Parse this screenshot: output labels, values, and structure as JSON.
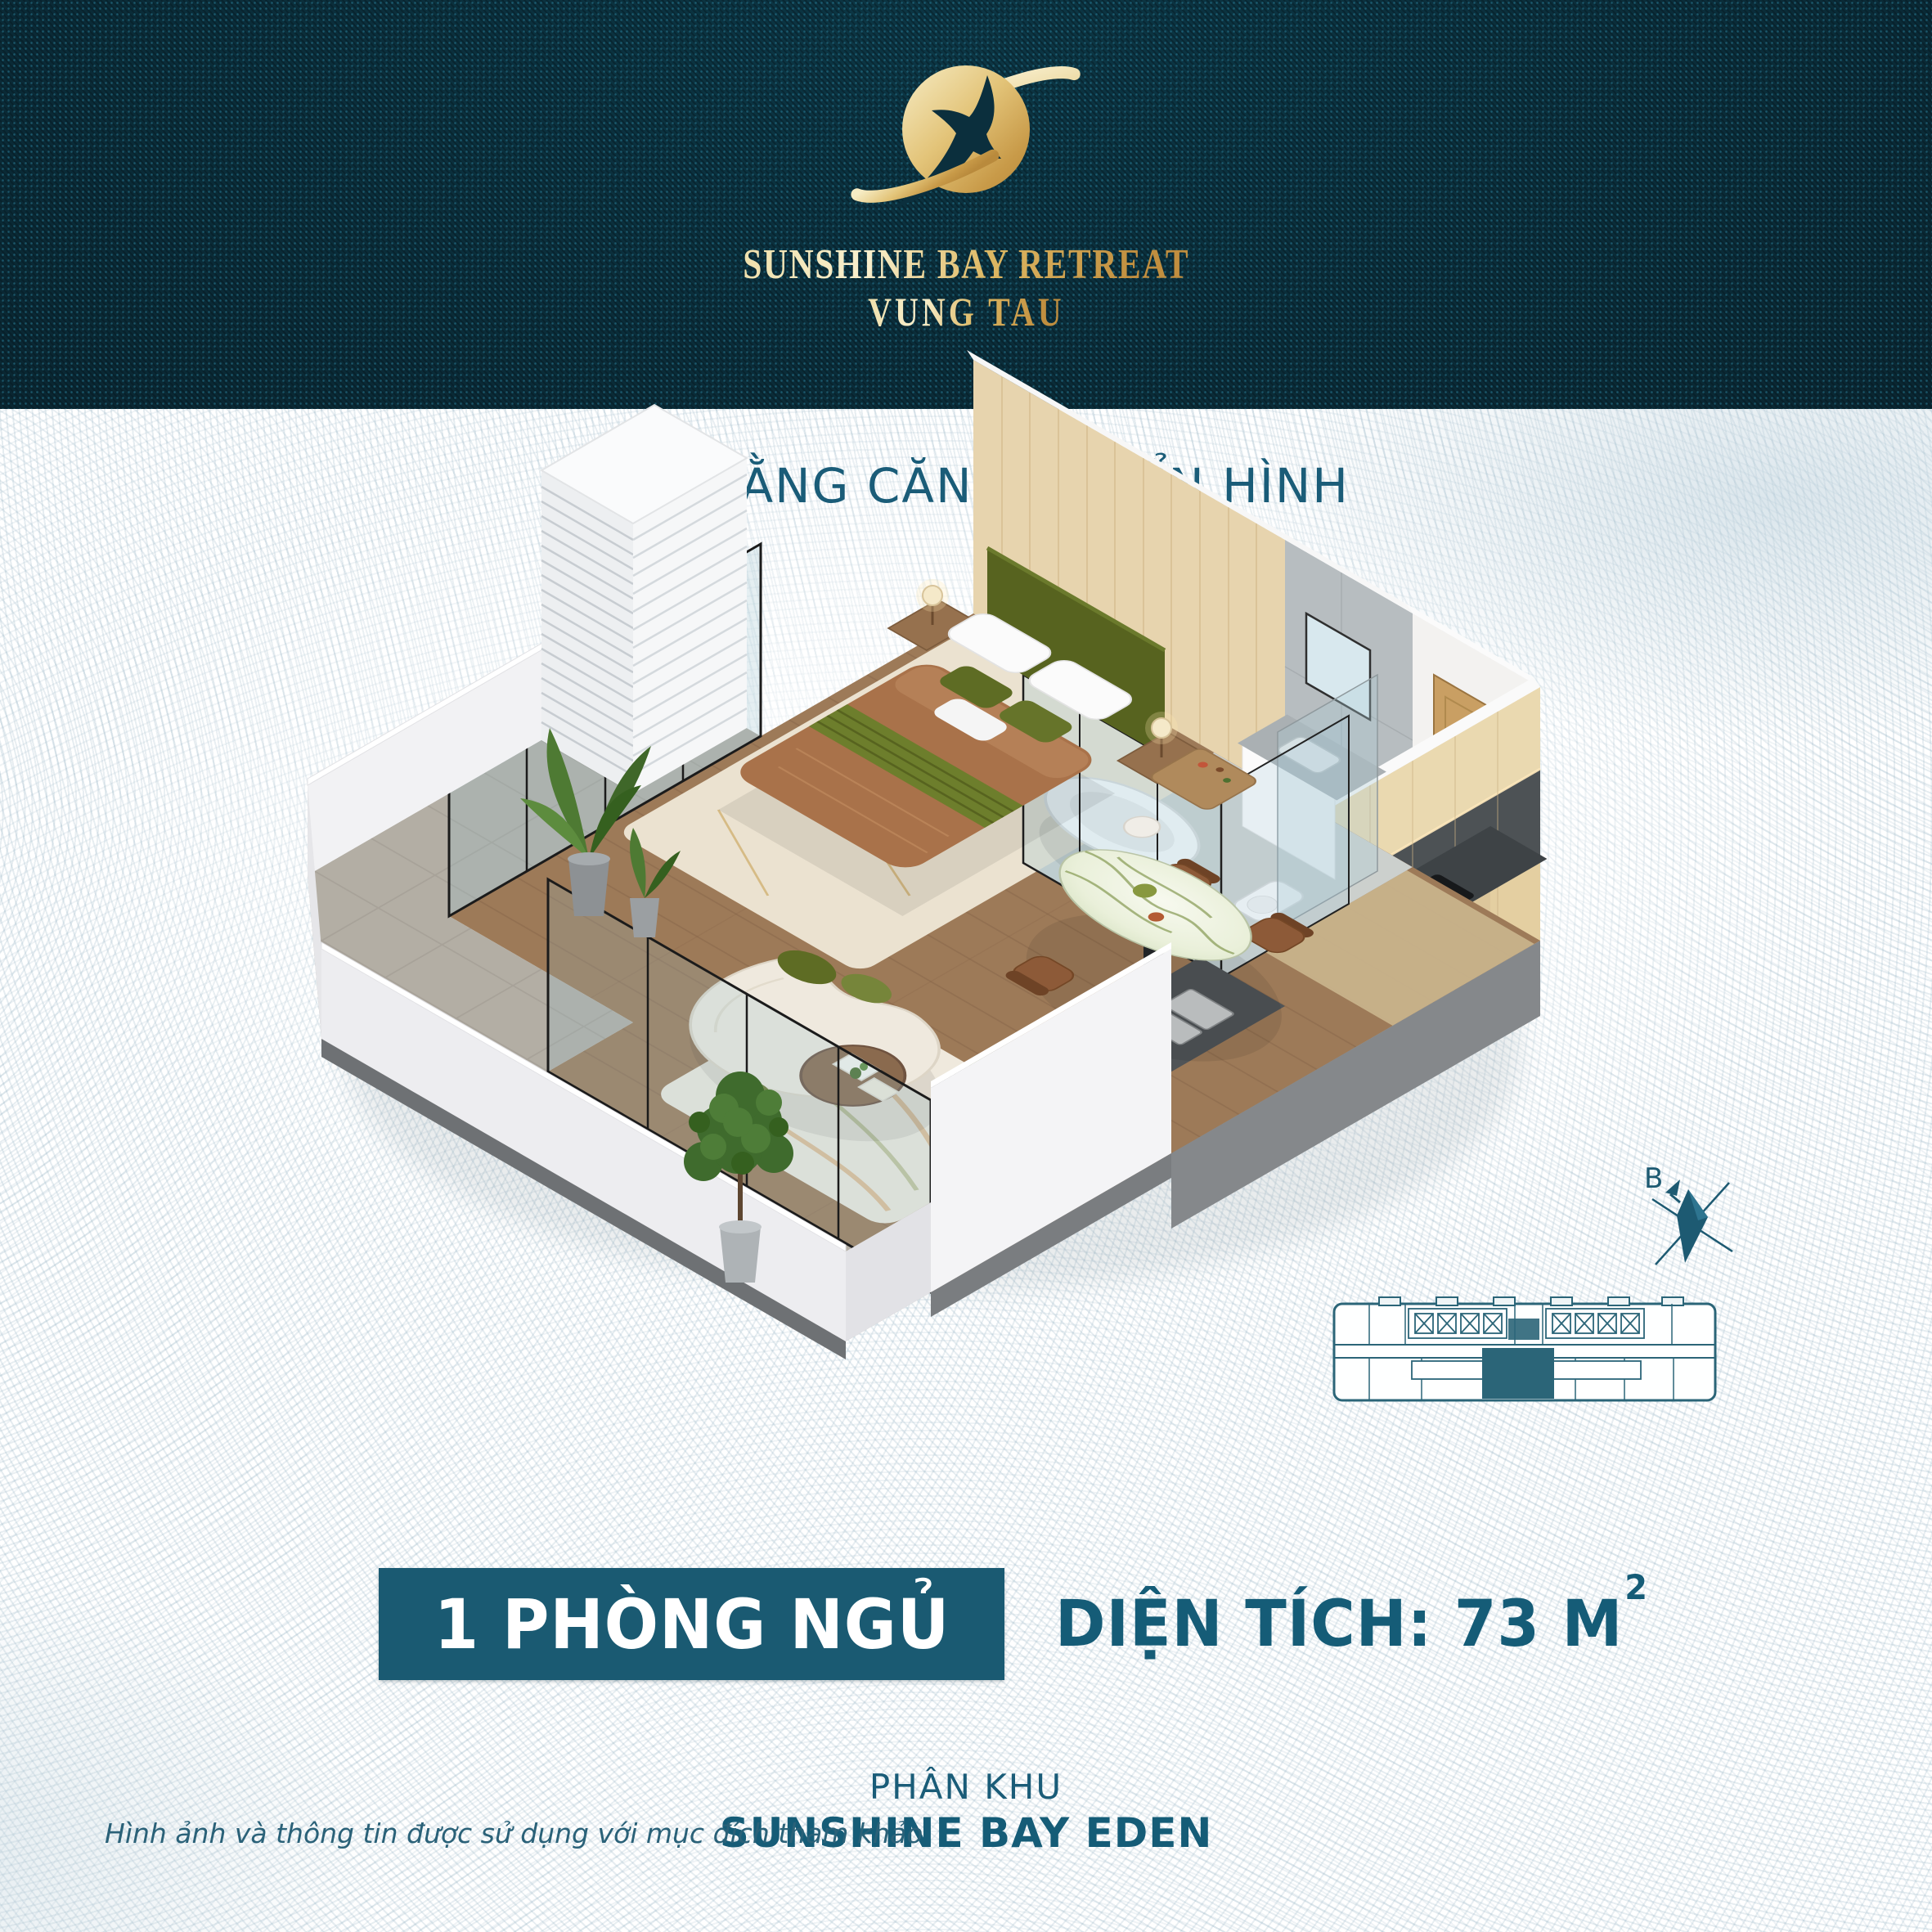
{
  "header": {
    "brand": "SUNSHINE BAY RETREAT",
    "location": "VUNG TAU",
    "logo_icon": "planet-star-icon",
    "background_color": "#0B2F3D",
    "gold_color": "#D9B45C"
  },
  "main": {
    "title": "MẶT BẰNG CĂN HỘ ĐIỂN HÌNH",
    "render_icon": "apartment-3d-floorplan",
    "compass": {
      "label": "B",
      "icon": "compass-north-icon"
    },
    "keyplan_icon": "building-keyplan-icon"
  },
  "details": {
    "bedrooms": "1 PHÒNG NGỦ",
    "area_label": "DIỆN TÍCH: 73 M",
    "area_sup": "2",
    "zone_label": "PHÂN KHU",
    "zone_name": "SUNSHINE BAY EDEN",
    "disclaimer": "Hình ảnh và thông tin được sử dụng với mục đích tham khảo"
  },
  "colors": {
    "teal_text": "#155C77",
    "banner_bg": "#1A5A72",
    "header_bg": "#0B2F3D",
    "gold": "#D9B45C",
    "wave_line": "#CFDEE5"
  }
}
